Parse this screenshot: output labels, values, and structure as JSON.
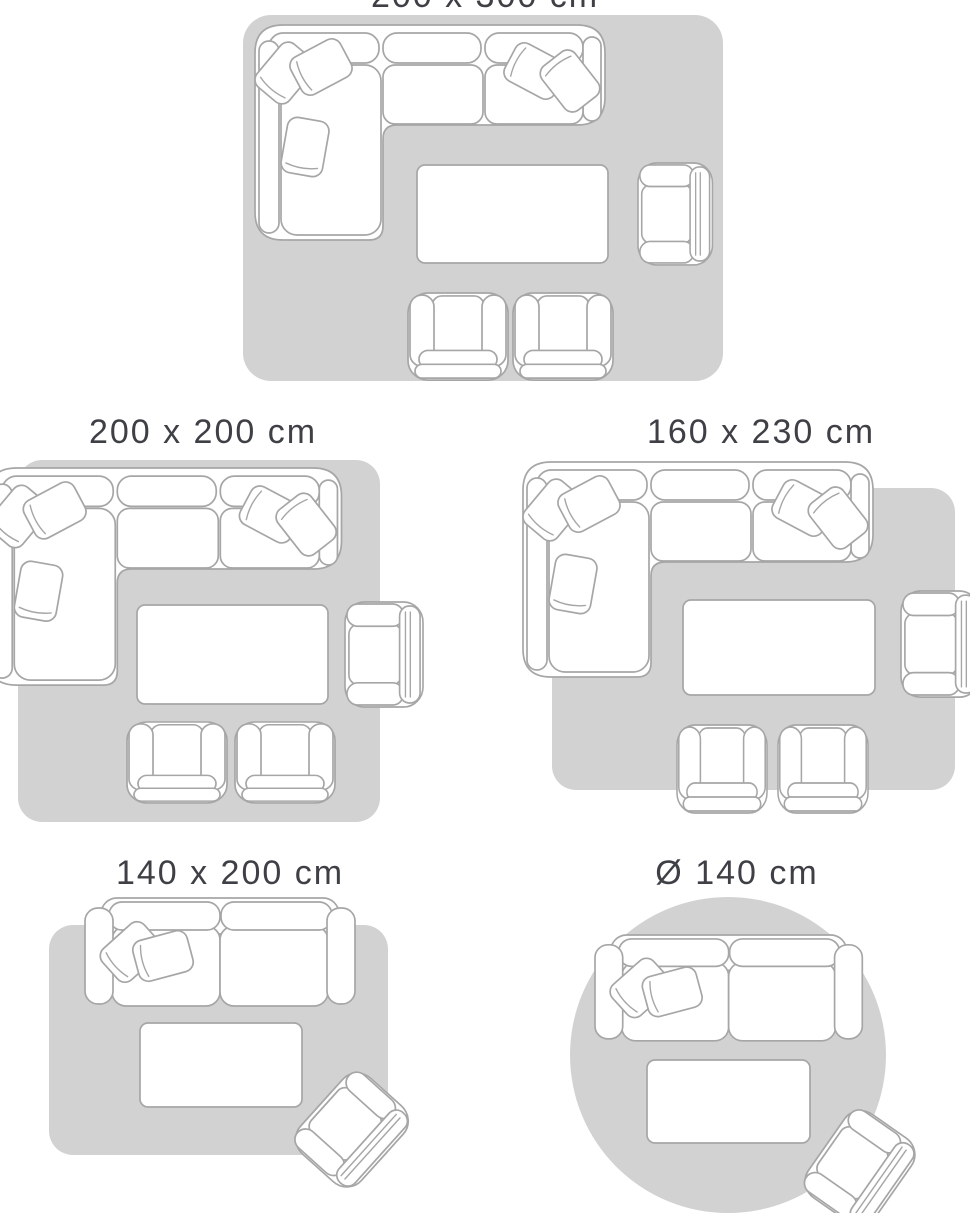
{
  "page": {
    "title": "Rug size guide",
    "background": "#ffffff"
  },
  "colors": {
    "rug_fill": "#d2d2d2",
    "furniture_outline": "#a6a6a6",
    "furniture_fill": "#ffffff",
    "label_text": "#3e4046"
  },
  "icons": {
    "corner-sofa-icon": "L-shaped sectional sofa with cushions and throw pillows, top view",
    "sofa-icon": "two-seat sofa with throw pillows, top view",
    "coffee-table-icon": "rectangular coffee table, top view",
    "armchair-icon": "armchair, top view",
    "club-chair-icon": "club chair, top view",
    "rug-shape": "grey rug area"
  },
  "size_guide": {
    "diagrams": [
      {
        "id": "rug-200x300",
        "label": "200 x 300 cm",
        "rug_shape": "rectangle",
        "furniture": [
          "corner-sofa",
          "coffee-table",
          "armchair",
          "club-chair",
          "club-chair"
        ]
      },
      {
        "id": "rug-200x200",
        "label": "200 x 200 cm",
        "rug_shape": "rectangle",
        "furniture": [
          "corner-sofa",
          "coffee-table",
          "armchair",
          "club-chair",
          "club-chair"
        ]
      },
      {
        "id": "rug-160x230",
        "label": "160 x 230 cm",
        "rug_shape": "rectangle",
        "furniture": [
          "corner-sofa",
          "coffee-table",
          "armchair",
          "club-chair",
          "club-chair"
        ]
      },
      {
        "id": "rug-140x200",
        "label": "140 x 200 cm",
        "rug_shape": "rectangle",
        "furniture": [
          "sofa",
          "coffee-table",
          "armchair"
        ]
      },
      {
        "id": "rug-round-140",
        "label": "Ø 140 cm",
        "rug_shape": "circle",
        "furniture": [
          "sofa",
          "coffee-table",
          "armchair"
        ]
      }
    ]
  }
}
